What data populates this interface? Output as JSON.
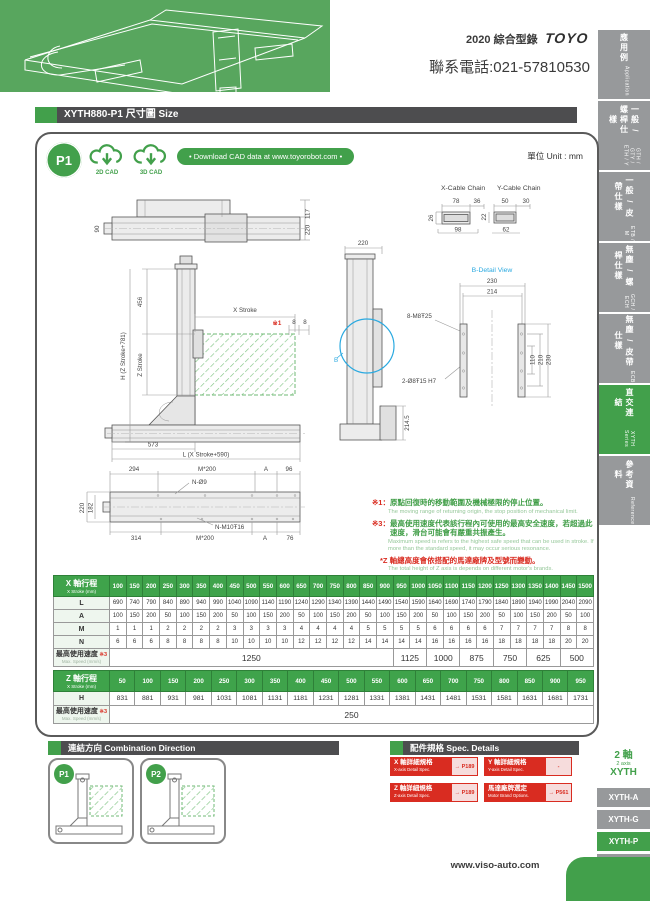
{
  "header": {
    "catalog": "2020 綜合型錄",
    "brand": "TOYO",
    "phone": "聯系電話:021-57810530"
  },
  "sidebar": {
    "tabs": [
      {
        "zh": "應用例",
        "en": "Application",
        "active": false
      },
      {
        "zh": "一般 / 螺桿仕樣",
        "en": "GTH / GTY / ETH / Y",
        "active": false
      },
      {
        "zh": "一般 / 皮帶仕樣",
        "en": "ETB / M",
        "active": false
      },
      {
        "zh": "無塵 / 螺桿仕樣",
        "en": "GCH / ECH",
        "active": false
      },
      {
        "zh": "無塵 / 皮帶仕樣",
        "en": "ECB",
        "active": false
      },
      {
        "zh": "直交連結",
        "en": "XYTH Series",
        "active": true
      },
      {
        "zh": "參考資料",
        "en": "Reference",
        "active": false
      }
    ]
  },
  "title_bar": {
    "text": "XYTH880-P1 尺寸圖 Size"
  },
  "cad": {
    "badge": "P1",
    "cad_2d": "2D CAD",
    "cad_3d": "3D CAD",
    "download": "• Download CAD data at www.toyorobot.com •"
  },
  "unit": "單位 Unit : mm",
  "drawing": {
    "top_view": {
      "d117": "117",
      "d220": "220",
      "d90": "90"
    },
    "cable": {
      "x_title": "X-Cable Chain",
      "y_title": "Y-Cable Chain",
      "x78": "78",
      "x36": "36",
      "x26": "26",
      "x98": "98",
      "y50": "50",
      "y30": "30",
      "y22": "22",
      "y62": "62"
    },
    "front": {
      "d456": "456",
      "dh": "H (Z Stroke+781)",
      "dz": "Z Stroke",
      "dx": "X Stroke",
      "ref1": "※1",
      "d8a": "8",
      "d8b": "8",
      "d573": "573",
      "dl": "L (X Stroke+590)"
    },
    "side": {
      "d220": "220",
      "d2145": "214.5",
      "b": "B"
    },
    "b_detail": {
      "title": "B-Detail View",
      "d230t": "230",
      "d214": "214",
      "m8": "8-M8Ŧ25",
      "h7": "2-Ø8Ŧ15 H7",
      "d110": "110",
      "d210": "210",
      "d230r": "230"
    },
    "plan": {
      "d294": "294",
      "m200t": "M*200",
      "at": "A",
      "d96": "96",
      "n9": "N-Ø9",
      "d220": "220",
      "d182": "182",
      "d314": "314",
      "m200b": "M*200",
      "m10": "N-M10Ŧ16",
      "ab": "A",
      "d76": "76"
    }
  },
  "notes": {
    "n1_ref": "※1：",
    "n1_zh": "原點回復時的移動範圍及機械極限的停止位置。",
    "n1_en": "The moving range of returning origin, the stop position of mechanical limit.",
    "n3_ref": "※3：",
    "n3_zh": "最高使用速度代表該行程內可使用的最高安全速度，若超過此速度，滑台可能會有嚴重共振產生。",
    "n3_en": "Maximum speed is refers to the highest safe speed that can be used in stroke. If more than the standard speed, it may occur serious resonance.",
    "z_zh": "*Z 軸總高度會依搭配的馬達廠牌及型號而變動。",
    "z_en": "The total height of Z axis is depends on different motor's brands."
  },
  "x_table": {
    "header_zh": "X 軸行程",
    "header_en": "X Stroke (mm)",
    "strokes": [
      100,
      150,
      200,
      250,
      300,
      350,
      400,
      450,
      500,
      550,
      600,
      650,
      700,
      750,
      800,
      850,
      900,
      950,
      1000,
      1050,
      1100,
      1150,
      1200,
      1250,
      1300,
      1350,
      1400,
      1450,
      1500
    ],
    "rows": [
      {
        "label": "L",
        "values": [
          690,
          740,
          790,
          840,
          890,
          940,
          990,
          1040,
          1090,
          1140,
          1190,
          1240,
          1290,
          1340,
          1390,
          1440,
          1490,
          1540,
          1590,
          1640,
          1690,
          1740,
          1790,
          1840,
          1890,
          1940,
          1990,
          2040,
          2090
        ]
      },
      {
        "label": "A",
        "values": [
          100,
          150,
          200,
          50,
          100,
          150,
          200,
          50,
          100,
          150,
          200,
          50,
          100,
          150,
          200,
          50,
          100,
          150,
          200,
          50,
          100,
          150,
          200,
          50,
          100,
          150,
          200,
          50,
          100
        ]
      },
      {
        "label": "M",
        "values": [
          1,
          1,
          1,
          2,
          2,
          2,
          2,
          3,
          3,
          3,
          3,
          4,
          4,
          4,
          4,
          5,
          5,
          5,
          5,
          6,
          6,
          6,
          6,
          7,
          7,
          7,
          7,
          8,
          8
        ]
      },
      {
        "label": "N",
        "values": [
          6,
          6,
          6,
          8,
          8,
          8,
          8,
          10,
          10,
          10,
          10,
          12,
          12,
          12,
          12,
          14,
          14,
          14,
          14,
          16,
          16,
          16,
          16,
          18,
          18,
          18,
          18,
          20,
          20
        ]
      }
    ],
    "speed_zh": "最高使用速度",
    "speed_ref": "※3",
    "speed_en": "Max. Speed (mm/s)",
    "speed_spans": [
      {
        "value": "1250",
        "cols": 17
      },
      {
        "value": "1125",
        "cols": 2
      },
      {
        "value": "1000",
        "cols": 2
      },
      {
        "value": "875",
        "cols": 2
      },
      {
        "value": "750",
        "cols": 2
      },
      {
        "value": "625",
        "cols": 2
      },
      {
        "value": "500",
        "cols": 2
      }
    ]
  },
  "z_table": {
    "header_zh": "Z 軸行程",
    "header_en": "X Stroke (mm)",
    "strokes": [
      50,
      100,
      150,
      200,
      250,
      300,
      350,
      400,
      450,
      500,
      550,
      600,
      650,
      700,
      750,
      800,
      850,
      900,
      950
    ],
    "rows": [
      {
        "label": "H",
        "values": [
          831,
          881,
          931,
          981,
          1031,
          1081,
          1131,
          1181,
          1231,
          1281,
          1331,
          1381,
          1431,
          1481,
          1531,
          1581,
          1631,
          1681,
          1731
        ]
      }
    ],
    "speed_zh": "最高使用速度",
    "speed_ref": "※3",
    "speed_en": "Max. Speed (mm/s)",
    "speed_spans": [
      {
        "value": "250",
        "cols": 19
      }
    ]
  },
  "combination": {
    "title": "連結方向 Combination Direction",
    "badges": [
      "P1",
      "P2"
    ]
  },
  "spec": {
    "title": "配件規格 Spec. Details",
    "buttons": [
      {
        "zh": "X 軸詳細規格",
        "en": "X-axis Detail Spec.",
        "link": "→ P189"
      },
      {
        "zh": "Y 軸詳細規格",
        "en": "Y-axis Detail Spec.",
        "link": "-"
      },
      {
        "zh": "Z 軸詳細規格",
        "en": "Z-axis Detail Spec.",
        "link": "→ P189"
      },
      {
        "zh": "馬達廠牌選定",
        "en": "Motor Brand Options.",
        "link": "→ P561"
      }
    ]
  },
  "series": {
    "axis_zh": "2 軸",
    "axis_en": "2 axis",
    "family": "XYTH",
    "tabs": [
      {
        "label": "XYTH-A",
        "active": false
      },
      {
        "label": "XYTH-G",
        "active": false
      },
      {
        "label": "XYTH-P",
        "active": true
      },
      {
        "label": "XYTH-F",
        "active": false
      }
    ]
  },
  "footer": {
    "url": "www.viso-auto.com"
  },
  "colors": {
    "green": "#42a04b",
    "red": "#d92c21",
    "blue": "#2aa9e0",
    "tab_gray": "#97999b",
    "bar_dark": "#4d4d4f"
  }
}
